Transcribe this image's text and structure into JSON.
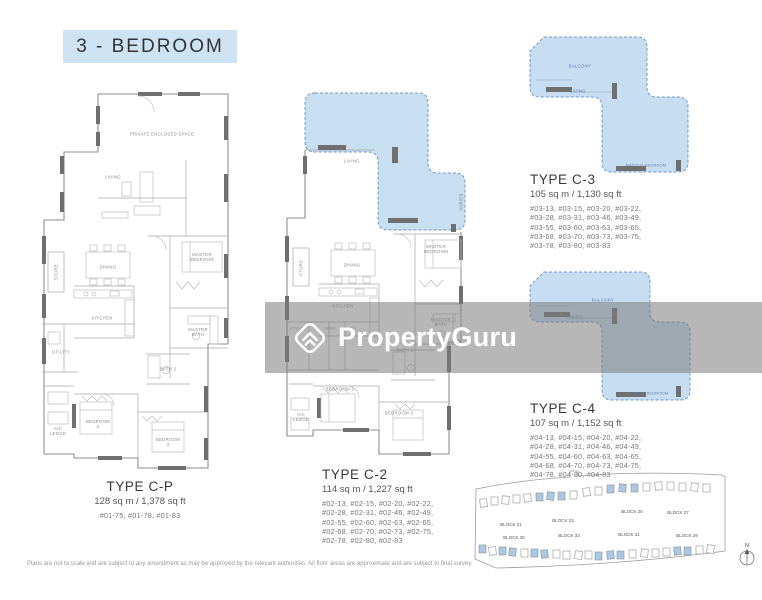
{
  "title": "3 - BEDROOM",
  "watermark": {
    "brand": "PropertyGuru"
  },
  "disclaimer": "Plans are not to scale and are subject to any amendment as may be approved by the relevant authorities. All floor areas are approximate and are subject to final survey.",
  "colors": {
    "title_bg": "#cde2f2",
    "highlight_fill": "#bed8ef",
    "highlight_border": "#6d9ac2",
    "plan_line": "#9a9a9a",
    "watermark_overlay": "rgba(123,123,123,0.55)",
    "brand_text": "#ffffff",
    "siteplan_block_blue": "#a9c8e6"
  },
  "plans": {
    "cp": {
      "name": "TYPE C-P",
      "area": "128 sq m / 1,378 sq ft",
      "unit_lines": [
        "#01-75, #01-78, #01-83"
      ],
      "rooms": {
        "pes": "PRIVATE ENCLOSED SPACE",
        "living": "LIVING",
        "store": "STORE",
        "dining": "DINING",
        "master_bedroom": "MASTER BEDROOM",
        "kitchen": "KITCHEN",
        "utility": "UTILITY",
        "master_bath": "MASTER BATH",
        "bath2": "BATH 2",
        "ac_ledge": "A/C LEDGE",
        "bedroom2": "BEDROOM 2",
        "bedroom3": "BEDROOM 3"
      }
    },
    "c2": {
      "name": "TYPE C-2",
      "area": "114 sq m / 1,227 sq ft",
      "unit_lines": [
        "#02-13, #02-15, #02-20, #02-22,",
        "#02-28, #02-31, #02-46, #02-49,",
        "#02-55, #02-60, #02-63, #02-65,",
        "#02-68, #02-70, #02-73, #02-75,",
        "#02-78, #02-80, #02-83"
      ],
      "rooms": {
        "living": "LIVING",
        "varies": "VARIES",
        "store": "STORE",
        "dining": "DINING",
        "master_bedroom": "MASTER BEDROOM",
        "kitchen": "KITCHEN",
        "utility": "UTILITY",
        "yard": "YARD",
        "wc": "WC",
        "master_bath": "MASTER BATH",
        "bath2": "BATH 2",
        "ac_ledge": "A/C LEDGE",
        "bedroom2": "BEDROOM 2",
        "bedroom3": "BEDROOM 3"
      }
    },
    "c3": {
      "name": "TYPE C-3",
      "area": "105 sq m / 1,130 sq ft",
      "unit_lines": [
        "#03-13, #03-15, #03-20, #03-22,",
        "#03-28, #03-31, #03-46, #03-49,",
        "#03-55, #03-60, #03-63, #03-65,",
        "#03-68, #03-70, #03-73, #03-75,",
        "#03-78, #03-80, #03-83"
      ],
      "rooms": {
        "balcony": "BALCONY",
        "living": "LIVING",
        "master_bedroom": "MASTER BEDROOM"
      }
    },
    "c4": {
      "name": "TYPE C-4",
      "area": "107 sq m / 1,152 sq ft",
      "unit_lines": [
        "#04-13, #04-15, #04-20, #04-22,",
        "#04-28, #04-31, #04-46, #04-49,",
        "#04-55, #04-60, #04-63, #04-65,",
        "#04-68, #04-70, #04-73, #04-75,",
        "#04-78, #04-80, #04-83"
      ],
      "rooms": {
        "balcony": "BALCONY",
        "living": "LIVING",
        "master_bedroom": "MASTER BEDROOM"
      }
    }
  },
  "siteplan": {
    "blocks": [
      "BLOCK 21",
      "BLOCK 23",
      "BLOCK 25",
      "BLOCK 27",
      "BLOCK 35",
      "BLOCK 33",
      "BLOCK 31",
      "BLOCK 29"
    ],
    "compass": "N"
  }
}
